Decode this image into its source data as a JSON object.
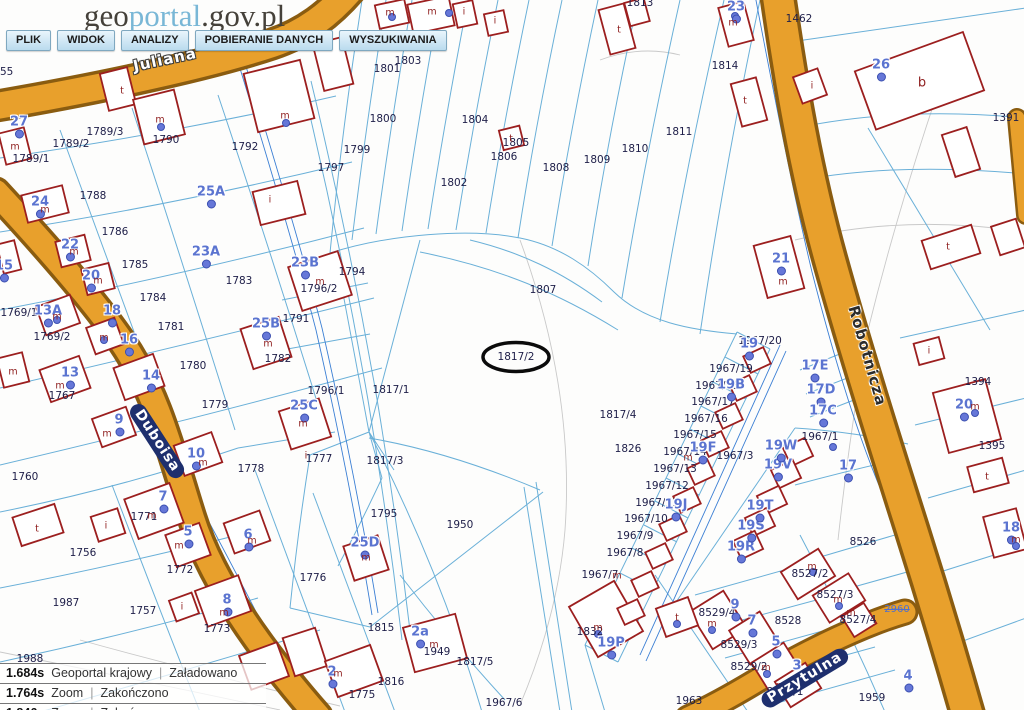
{
  "header": {
    "logo": {
      "part1": "geo",
      "part2": "portal",
      "part3": ".gov.pl"
    },
    "menu": [
      "PLIK",
      "WIDOK",
      "ANALIZY",
      "POBIERANIE DANYCH",
      "WYSZUKIWANIA"
    ]
  },
  "statusbar": {
    "rows": [
      {
        "time": "1.684s",
        "layer": "Geoportal krajowy",
        "status": "Załadowano"
      },
      {
        "time": "1.764s",
        "layer": "Zoom",
        "status": "Zakończono"
      },
      {
        "time": "1.846s",
        "layer": "Zoom",
        "status": "Zakończono"
      }
    ]
  },
  "colors": {
    "street": "#e8a02c",
    "street_casing": "#8a5c10",
    "parcel_line": "#6ab0d8",
    "building": "#9c1f1f",
    "house_number": "#5b74d0",
    "parcel_text": "#20204a",
    "utility": "#3b7fd4"
  },
  "map": {
    "highlighted_parcel": "1817/2",
    "streets": [
      {
        "t": "Juliana",
        "x": 165,
        "y": 60,
        "rot": -12,
        "style": "halo"
      },
      {
        "t": "Duboisa",
        "x": 157,
        "y": 441,
        "rot": 57,
        "style": "plate"
      },
      {
        "t": "Robotnicza",
        "x": 867,
        "y": 356,
        "rot": 74,
        "style": "dark"
      },
      {
        "t": "Przytulna",
        "x": 805,
        "y": 678,
        "rot": -31,
        "style": "plate"
      }
    ],
    "parcels": [
      {
        "t": "1755",
        "x": 0,
        "y": 72
      },
      {
        "t": "1789/3",
        "x": 105,
        "y": 132
      },
      {
        "t": "1789/2",
        "x": 71,
        "y": 144
      },
      {
        "t": "1789/1",
        "x": 31,
        "y": 159
      },
      {
        "t": "1790",
        "x": 166,
        "y": 140
      },
      {
        "t": "1792",
        "x": 245,
        "y": 147
      },
      {
        "t": "1788",
        "x": 93,
        "y": 196
      },
      {
        "t": "1786",
        "x": 115,
        "y": 232
      },
      {
        "t": "1785",
        "x": 135,
        "y": 265
      },
      {
        "t": "1784",
        "x": 153,
        "y": 298
      },
      {
        "t": "1783",
        "x": 239,
        "y": 281
      },
      {
        "t": "1781",
        "x": 171,
        "y": 327
      },
      {
        "t": "1780",
        "x": 193,
        "y": 366
      },
      {
        "t": "1779",
        "x": 215,
        "y": 405
      },
      {
        "t": "1782",
        "x": 278,
        "y": 359
      },
      {
        "t": "1769/1",
        "x": 19,
        "y": 313
      },
      {
        "t": "1769/2",
        "x": 52,
        "y": 337
      },
      {
        "t": "1767",
        "x": 62,
        "y": 396
      },
      {
        "t": "1760",
        "x": 25,
        "y": 477
      },
      {
        "t": "1756",
        "x": 83,
        "y": 553
      },
      {
        "t": "1987",
        "x": 66,
        "y": 603
      },
      {
        "t": "1757",
        "x": 143,
        "y": 611
      },
      {
        "t": "1771",
        "x": 144,
        "y": 517
      },
      {
        "t": "1772",
        "x": 180,
        "y": 570
      },
      {
        "t": "1773",
        "x": 217,
        "y": 629
      },
      {
        "t": "1775",
        "x": 362,
        "y": 695
      },
      {
        "t": "1776",
        "x": 313,
        "y": 578
      },
      {
        "t": "1777",
        "x": 319,
        "y": 459
      },
      {
        "t": "1778",
        "x": 251,
        "y": 469
      },
      {
        "t": "1794",
        "x": 352,
        "y": 272
      },
      {
        "t": "1796/2",
        "x": 319,
        "y": 289
      },
      {
        "t": "1791",
        "x": 296,
        "y": 319
      },
      {
        "t": "1796/1",
        "x": 326,
        "y": 391
      },
      {
        "t": "1795",
        "x": 384,
        "y": 514
      },
      {
        "t": "1797",
        "x": 331,
        "y": 168
      },
      {
        "t": "1799",
        "x": 357,
        "y": 150
      },
      {
        "t": "1800",
        "x": 383,
        "y": 119
      },
      {
        "t": "1801",
        "x": 387,
        "y": 69
      },
      {
        "t": "1803",
        "x": 408,
        "y": 61
      },
      {
        "t": "1802",
        "x": 454,
        "y": 183
      },
      {
        "t": "1804",
        "x": 475,
        "y": 120
      },
      {
        "t": "1805",
        "x": 516,
        "y": 143
      },
      {
        "t": "1806",
        "x": 504,
        "y": 157
      },
      {
        "t": "1807",
        "x": 543,
        "y": 290
      },
      {
        "t": "1808",
        "x": 556,
        "y": 168
      },
      {
        "t": "1809",
        "x": 597,
        "y": 160
      },
      {
        "t": "1810",
        "x": 635,
        "y": 149
      },
      {
        "t": "1811",
        "x": 679,
        "y": 132
      },
      {
        "t": "1813",
        "x": 640,
        "y": 3
      },
      {
        "t": "1814",
        "x": 725,
        "y": 66
      },
      {
        "t": "1817/1",
        "x": 391,
        "y": 390
      },
      {
        "t": "1817/2",
        "x": 516,
        "y": 357
      },
      {
        "t": "1817/3",
        "x": 385,
        "y": 461
      },
      {
        "t": "1817/4",
        "x": 618,
        "y": 415
      },
      {
        "t": "1826",
        "x": 628,
        "y": 449
      },
      {
        "t": "1817/5",
        "x": 475,
        "y": 662
      },
      {
        "t": "1816",
        "x": 391,
        "y": 682
      },
      {
        "t": "1815",
        "x": 381,
        "y": 628
      },
      {
        "t": "1949",
        "x": 437,
        "y": 652
      },
      {
        "t": "1950",
        "x": 460,
        "y": 525
      },
      {
        "t": "1963",
        "x": 689,
        "y": 701
      },
      {
        "t": "1832",
        "x": 590,
        "y": 632
      },
      {
        "t": "1462",
        "x": 799,
        "y": 19
      },
      {
        "t": "1391",
        "x": 1006,
        "y": 118
      },
      {
        "t": "1394",
        "x": 978,
        "y": 382
      },
      {
        "t": "1395",
        "x": 992,
        "y": 446
      },
      {
        "t": "8526",
        "x": 863,
        "y": 542
      },
      {
        "t": "8527/2",
        "x": 810,
        "y": 574
      },
      {
        "t": "8527/3",
        "x": 835,
        "y": 595
      },
      {
        "t": "8527/4",
        "x": 858,
        "y": 620
      },
      {
        "t": "8528",
        "x": 788,
        "y": 621
      },
      {
        "t": "8529/4",
        "x": 717,
        "y": 613
      },
      {
        "t": "8529/3",
        "x": 739,
        "y": 645
      },
      {
        "t": "8529/2",
        "x": 749,
        "y": 667
      },
      {
        "t": "8529/1",
        "x": 785,
        "y": 692
      },
      {
        "t": "1967/20",
        "x": 760,
        "y": 341
      },
      {
        "t": "1967/19",
        "x": 731,
        "y": 369
      },
      {
        "t": "1967/18",
        "x": 717,
        "y": 386
      },
      {
        "t": "1967/17",
        "x": 713,
        "y": 402
      },
      {
        "t": "1967/16",
        "x": 706,
        "y": 419
      },
      {
        "t": "1967/15",
        "x": 695,
        "y": 435
      },
      {
        "t": "1967/14",
        "x": 685,
        "y": 452
      },
      {
        "t": "1967/13",
        "x": 675,
        "y": 469
      },
      {
        "t": "1967/12",
        "x": 667,
        "y": 486
      },
      {
        "t": "1967/11",
        "x": 657,
        "y": 503
      },
      {
        "t": "1967/10",
        "x": 646,
        "y": 519
      },
      {
        "t": "1967/9",
        "x": 635,
        "y": 536
      },
      {
        "t": "1967/8",
        "x": 625,
        "y": 553
      },
      {
        "t": "1967/3",
        "x": 735,
        "y": 456
      },
      {
        "t": "1967/1",
        "x": 820,
        "y": 437
      },
      {
        "t": "1967/7",
        "x": 600,
        "y": 575
      },
      {
        "t": "1967/6",
        "x": 504,
        "y": 703
      },
      {
        "t": "1959",
        "x": 872,
        "y": 698
      },
      {
        "t": "1988",
        "x": 30,
        "y": 659
      }
    ],
    "houses": [
      {
        "t": "27",
        "x": 19,
        "y": 122
      },
      {
        "t": "24",
        "x": 40,
        "y": 202
      },
      {
        "t": "25A",
        "x": 211,
        "y": 192
      },
      {
        "t": "23A",
        "x": 206,
        "y": 252
      },
      {
        "t": "23B",
        "x": 305,
        "y": 263
      },
      {
        "t": "25B",
        "x": 266,
        "y": 324
      },
      {
        "t": "25C",
        "x": 304,
        "y": 406
      },
      {
        "t": "25D",
        "x": 365,
        "y": 543
      },
      {
        "t": "22",
        "x": 70,
        "y": 245
      },
      {
        "t": "20",
        "x": 91,
        "y": 276
      },
      {
        "t": "18",
        "x": 112,
        "y": 311
      },
      {
        "t": "16",
        "x": 129,
        "y": 340
      },
      {
        "t": "14",
        "x": 151,
        "y": 376
      },
      {
        "t": "13A",
        "x": 48,
        "y": 311
      },
      {
        "t": "15",
        "x": 4,
        "y": 266
      },
      {
        "t": "13",
        "x": 70,
        "y": 373
      },
      {
        "t": "10",
        "x": 196,
        "y": 454
      },
      {
        "t": "9",
        "x": 119,
        "y": 420
      },
      {
        "t": "7",
        "x": 163,
        "y": 497
      },
      {
        "t": "5",
        "x": 188,
        "y": 532
      },
      {
        "t": "6",
        "x": 248,
        "y": 535
      },
      {
        "t": "8",
        "x": 227,
        "y": 600
      },
      {
        "t": "2",
        "x": 332,
        "y": 672
      },
      {
        "t": "2a",
        "x": 420,
        "y": 632
      },
      {
        "t": "26",
        "x": 881,
        "y": 65
      },
      {
        "t": "23",
        "x": 736,
        "y": 7
      },
      {
        "t": "21",
        "x": 781,
        "y": 259
      },
      {
        "t": "19",
        "x": 749,
        "y": 344
      },
      {
        "t": "19B",
        "x": 731,
        "y": 385
      },
      {
        "t": "19F",
        "x": 703,
        "y": 448
      },
      {
        "t": "19J",
        "x": 676,
        "y": 505
      },
      {
        "t": "19P",
        "x": 611,
        "y": 643
      },
      {
        "t": "19R",
        "x": 741,
        "y": 547
      },
      {
        "t": "19S",
        "x": 751,
        "y": 526
      },
      {
        "t": "19T",
        "x": 760,
        "y": 506
      },
      {
        "t": "19V",
        "x": 778,
        "y": 465
      },
      {
        "t": "19W",
        "x": 781,
        "y": 446
      },
      {
        "t": "17E",
        "x": 815,
        "y": 366
      },
      {
        "t": "17D",
        "x": 821,
        "y": 390
      },
      {
        "t": "17C",
        "x": 823,
        "y": 411
      },
      {
        "t": "17",
        "x": 848,
        "y": 466
      },
      {
        "t": "20",
        "x": 964,
        "y": 405
      },
      {
        "t": "18",
        "x": 1011,
        "y": 528
      },
      {
        "t": "9",
        "x": 735,
        "y": 605
      },
      {
        "t": "7",
        "x": 752,
        "y": 621
      },
      {
        "t": "5",
        "x": 776,
        "y": 642
      },
      {
        "t": "3",
        "x": 797,
        "y": 666
      },
      {
        "t": "4",
        "x": 908,
        "y": 676
      }
    ],
    "letters": [
      {
        "t": "m",
        "x": 15,
        "y": 147
      },
      {
        "t": "m",
        "x": 45,
        "y": 210
      },
      {
        "t": "m",
        "x": 74,
        "y": 252
      },
      {
        "t": "m",
        "x": 98,
        "y": 281
      },
      {
        "t": "m",
        "x": 13,
        "y": 372
      },
      {
        "t": "m",
        "x": 57,
        "y": 317
      },
      {
        "t": "m",
        "x": 104,
        "y": 338
      },
      {
        "t": "m",
        "x": 60,
        "y": 386
      },
      {
        "t": "m",
        "x": 107,
        "y": 434
      },
      {
        "t": "m",
        "x": 203,
        "y": 463
      },
      {
        "t": "m",
        "x": 160,
        "y": 120
      },
      {
        "t": "m",
        "x": 285,
        "y": 116
      },
      {
        "t": "m",
        "x": 390,
        "y": 13
      },
      {
        "t": "m",
        "x": 432,
        "y": 12
      },
      {
        "t": "m",
        "x": 733,
        "y": 23
      },
      {
        "t": "m",
        "x": 320,
        "y": 282
      },
      {
        "t": "m",
        "x": 268,
        "y": 344
      },
      {
        "t": "m",
        "x": 303,
        "y": 424
      },
      {
        "t": "m",
        "x": 366,
        "y": 558
      },
      {
        "t": "m",
        "x": 338,
        "y": 674
      },
      {
        "t": "m",
        "x": 434,
        "y": 645
      },
      {
        "t": "m",
        "x": 152,
        "y": 516
      },
      {
        "t": "m",
        "x": 179,
        "y": 546
      },
      {
        "t": "m",
        "x": 252,
        "y": 541
      },
      {
        "t": "m",
        "x": 224,
        "y": 613
      },
      {
        "t": "m",
        "x": 783,
        "y": 282
      },
      {
        "t": "m",
        "x": 812,
        "y": 567
      },
      {
        "t": "m",
        "x": 838,
        "y": 600
      },
      {
        "t": "m",
        "x": 851,
        "y": 613
      },
      {
        "t": "m",
        "x": 712,
        "y": 624
      },
      {
        "t": "m",
        "x": 766,
        "y": 668
      },
      {
        "t": "m",
        "x": 781,
        "y": 686
      },
      {
        "t": "m",
        "x": 598,
        "y": 628
      },
      {
        "t": "m",
        "x": 975,
        "y": 407
      },
      {
        "t": "m",
        "x": 1016,
        "y": 540
      },
      {
        "t": "m",
        "x": 617,
        "y": 576
      },
      {
        "t": "m",
        "x": 688,
        "y": 458
      },
      {
        "t": "t",
        "x": 122,
        "y": 91
      },
      {
        "t": "t",
        "x": 619,
        "y": 30
      },
      {
        "t": "t",
        "x": 745,
        "y": 101
      },
      {
        "t": "t",
        "x": 37,
        "y": 529
      },
      {
        "t": "t",
        "x": 511,
        "y": 139
      },
      {
        "t": "t",
        "x": 948,
        "y": 247
      },
      {
        "t": "t",
        "x": 987,
        "y": 477
      },
      {
        "t": "t",
        "x": 677,
        "y": 618
      },
      {
        "t": "i",
        "x": 270,
        "y": 200
      },
      {
        "t": "i",
        "x": 464,
        "y": 12
      },
      {
        "t": "i",
        "x": 495,
        "y": 21
      },
      {
        "t": "i",
        "x": 106,
        "y": 526
      },
      {
        "t": "i",
        "x": 182,
        "y": 607
      },
      {
        "t": "i",
        "x": 812,
        "y": 86
      },
      {
        "t": "i",
        "x": 929,
        "y": 351
      },
      {
        "t": "i",
        "x": 306,
        "y": 456
      },
      {
        "t": "b",
        "x": 922,
        "y": 83,
        "cls": "big"
      }
    ],
    "misc": [
      {
        "t": "2960",
        "x": 897,
        "y": 610
      }
    ]
  }
}
